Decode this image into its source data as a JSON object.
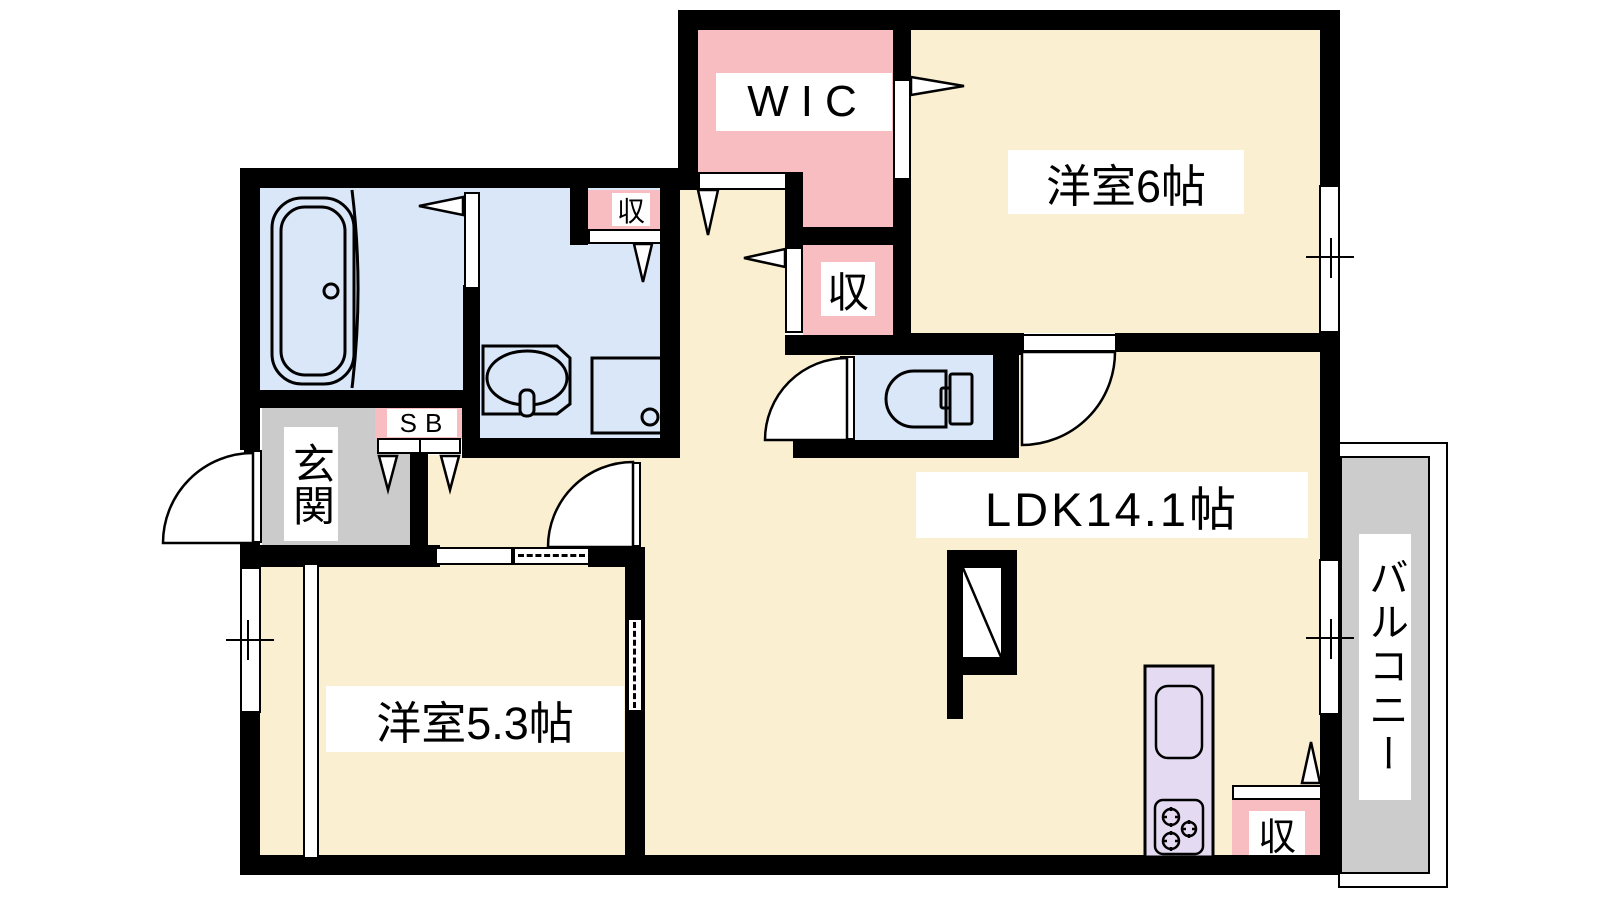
{
  "title": "2LDK apartment floor plan",
  "plan_type": "floor-plan",
  "rooms": [
    {
      "id": "wic",
      "label": "WIC",
      "type": "walk-in-closet"
    },
    {
      "id": "bedroom6",
      "label": "洋室6帖",
      "type": "western-room",
      "size_jo": 6
    },
    {
      "id": "ldk",
      "label": "LDK14.1帖",
      "type": "living-dining-kitchen",
      "size_jo": 14.1
    },
    {
      "id": "bedroom53",
      "label": "洋室5.3帖",
      "type": "western-room",
      "size_jo": 5.3
    },
    {
      "id": "entrance",
      "label": "玄関",
      "type": "entrance"
    },
    {
      "id": "balcony",
      "label": "バルコニー",
      "type": "balcony"
    }
  ],
  "storage_label": "収",
  "shoebox_label": "SB",
  "fixtures": [
    "bathtub",
    "washbasin",
    "washing-machine-pan",
    "toilet",
    "kitchen-sink",
    "gas-stove"
  ],
  "colors": {
    "wall": "#000000",
    "room_cream": "#FAEFD0",
    "closet_pink": "#F8BDC1",
    "wet_area_blue": "#DAE7F8",
    "entrance_gray": "#CBCBCB",
    "balcony_gray": "#CCCCCC",
    "kitchen_purple": "#E4DBF2",
    "background": "#FFFFFF"
  }
}
